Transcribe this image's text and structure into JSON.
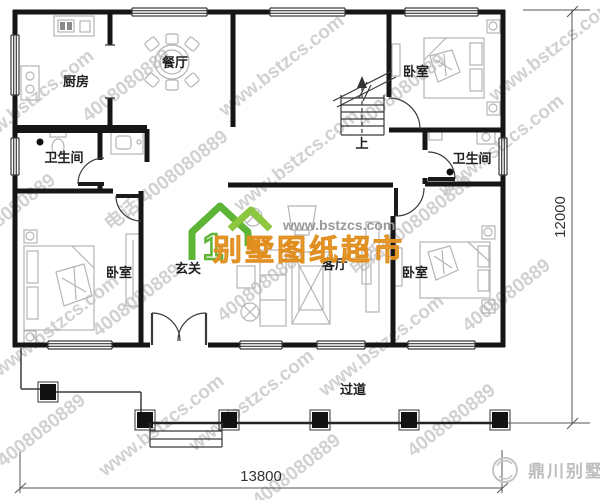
{
  "plan": {
    "rooms": {
      "kitchen": "厨房",
      "dining": "餐厅",
      "bedroom_top_right": "卧室",
      "bathroom_left": "卫生间",
      "bathroom_right": "卫生间",
      "bedroom_bottom_left": "卧室",
      "foyer": "玄关",
      "living": "客厅",
      "bedroom_bottom_right": "卧室",
      "corridor": "过道",
      "stairs_up": "上"
    },
    "dimensions": {
      "width_mm": "13800",
      "height_mm": "12000"
    }
  },
  "watermark": {
    "site": "www.bstzcs.com",
    "phone": "4008080889",
    "phone_label": "电话:4008080889"
  },
  "logo_center": {
    "site": "www.bstzcs.com",
    "name": "别墅图纸超市",
    "house_number": "1"
  },
  "logo_bottom_right": {
    "name": "鼎川别墅"
  },
  "colors": {
    "wall": "#161616",
    "furniture": "#b5b5b5",
    "watermark": "#c6c6c6",
    "logo_green": "#5eb535",
    "logo_orange": "#f1a53a",
    "brand_gray": "#bdbdbd"
  }
}
